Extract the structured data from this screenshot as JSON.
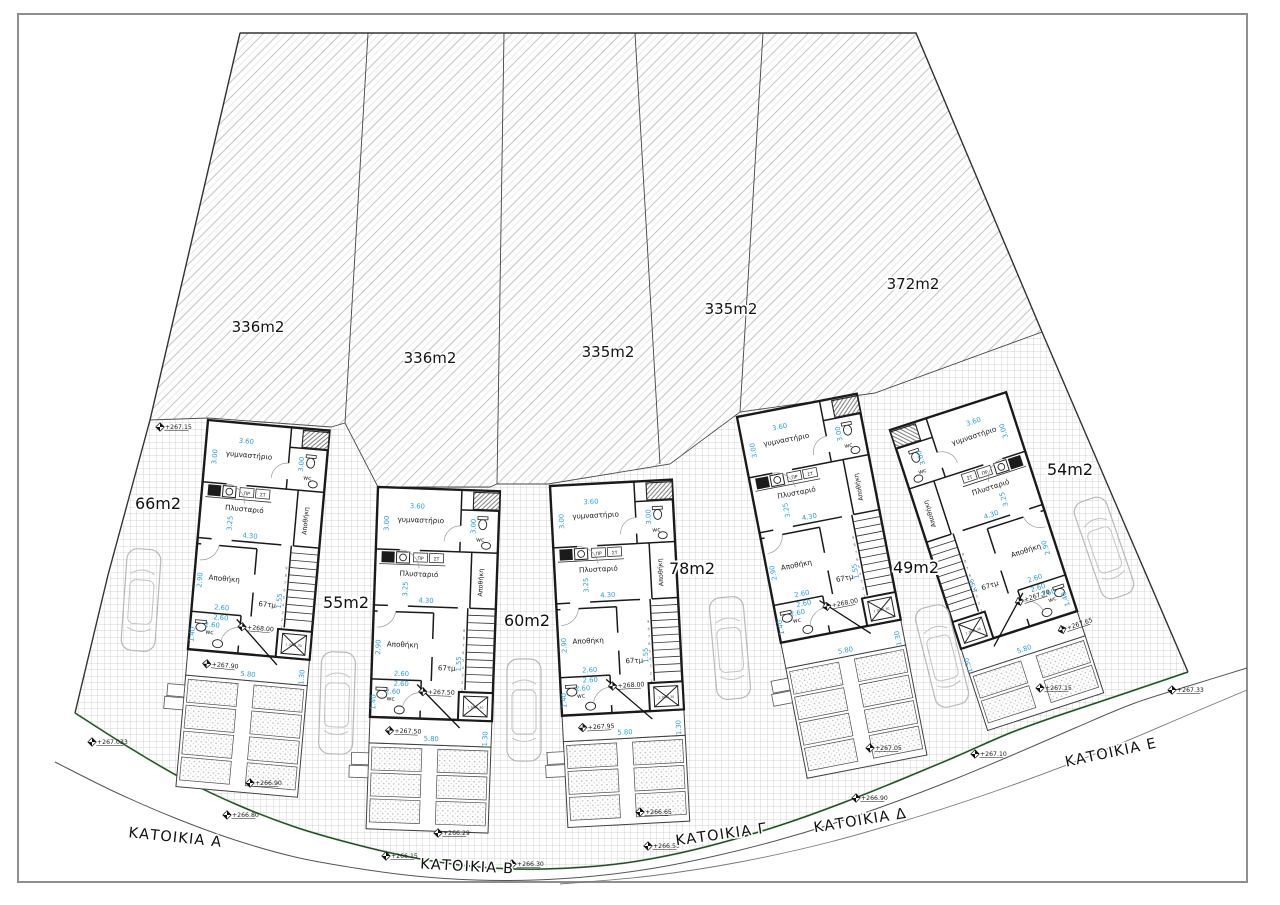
{
  "plots": [
    {
      "label": "336m2",
      "x": 258,
      "y": 332
    },
    {
      "label": "336m2",
      "x": 430,
      "y": 363
    },
    {
      "label": "335m2",
      "x": 608,
      "y": 357
    },
    {
      "label": "335m2",
      "x": 731,
      "y": 314
    },
    {
      "label": "372m2",
      "x": 913,
      "y": 289
    }
  ],
  "yard_areas": [
    {
      "label": "66m2",
      "x": 158,
      "y": 509
    },
    {
      "label": "55m2",
      "x": 346,
      "y": 608
    },
    {
      "label": "60m2",
      "x": 527,
      "y": 626
    },
    {
      "label": "78m2",
      "x": 692,
      "y": 574
    },
    {
      "label": "49m2",
      "x": 916,
      "y": 573
    },
    {
      "label": "54m2",
      "x": 1070,
      "y": 475
    }
  ],
  "houses": [
    {
      "name": "ΚΑΤΟΙΚΙΑ A",
      "x": 208,
      "y": 420,
      "rot": 5,
      "mirror": false,
      "garden_rows": 4,
      "floor_level": "+268.00",
      "terrace_level": "+267.90",
      "label": {
        "x": 175,
        "y": 842,
        "rot": 6
      }
    },
    {
      "name": "ΚΑΤΟΙΚΙΑ B",
      "x": 378,
      "y": 487,
      "rot": 2,
      "mirror": false,
      "garden_rows": 3,
      "floor_level": "+267.50",
      "terrace_level": "+267.50",
      "label": {
        "x": 467,
        "y": 871,
        "rot": 3
      }
    },
    {
      "name": "ΚΑΤΟΙΚΙΑ Γ",
      "x": 550,
      "y": 486,
      "rot": -3,
      "mirror": false,
      "garden_rows": 3,
      "floor_level": "+268.00",
      "terrace_level": "+267.95",
      "label": {
        "x": 722,
        "y": 839,
        "rot": -8
      }
    },
    {
      "name": "ΚΑΤΟΙΚΙΑ Δ",
      "x": 737,
      "y": 417,
      "rot": -11,
      "mirror": false,
      "garden_rows": 4,
      "floor_level": "+268.00",
      "terrace_level": "",
      "label": {
        "x": 861,
        "y": 825,
        "rot": -9
      }
    },
    {
      "name": "ΚΑΤΟΙΚΙΑ E",
      "x": 890,
      "y": 430,
      "rot": -18,
      "mirror": true,
      "garden_rows": 2,
      "floor_level": "+267.70",
      "terrace_level": "+267.65",
      "label": {
        "x": 1112,
        "y": 757,
        "rot": -12
      }
    }
  ],
  "rooms": {
    "gym": "γυμναστήριο",
    "laundry": "Πλυσταριό",
    "storage": "Αποθήκη",
    "closet": "Αποθήκη",
    "wc": "wc",
    "floor_area": "67τμ"
  },
  "dims": {
    "gym_w": "3.60",
    "gym_h": "3.00",
    "wc_column": "3.00",
    "laundry_h": "3.25",
    "laundry_w": "4.30",
    "storage_h": "2.90",
    "storage_w": "2.60",
    "wc_w": "2.60",
    "wc_w2": "2.60",
    "wc_h": "1.40",
    "stairwell": "1.55",
    "terrace_w": "5.80",
    "garden_side": "1.30",
    "washer_tag_1": "ΠΡ",
    "washer_tag_2": "ΣΤ",
    "elevator": "1.30x1.30"
  },
  "site_markers": [
    {
      "x": 160,
      "y": 427,
      "label": "+267.15"
    },
    {
      "x": 92,
      "y": 742,
      "label": "+267.033"
    },
    {
      "x": 227,
      "y": 815,
      "label": "+266.80"
    },
    {
      "x": 250,
      "y": 783,
      "label": "+266.90"
    },
    {
      "x": 386,
      "y": 856,
      "label": "+266.15"
    },
    {
      "x": 438,
      "y": 833,
      "label": "+266.29"
    },
    {
      "x": 512,
      "y": 864,
      "label": "+266.30"
    },
    {
      "x": 648,
      "y": 846,
      "label": "+266.50"
    },
    {
      "x": 640,
      "y": 812,
      "label": "+266.65"
    },
    {
      "x": 856,
      "y": 798,
      "label": "+266.90"
    },
    {
      "x": 870,
      "y": 748,
      "label": "+267.05"
    },
    {
      "x": 975,
      "y": 754,
      "label": "+267.10"
    },
    {
      "x": 1040,
      "y": 688,
      "label": "+267.15"
    },
    {
      "x": 1172,
      "y": 690,
      "label": "+267.33"
    }
  ],
  "colors": {
    "dim_text": "#2b9cd8",
    "wall": "#1a1a1a",
    "boundary_green": "#3e8e41"
  }
}
